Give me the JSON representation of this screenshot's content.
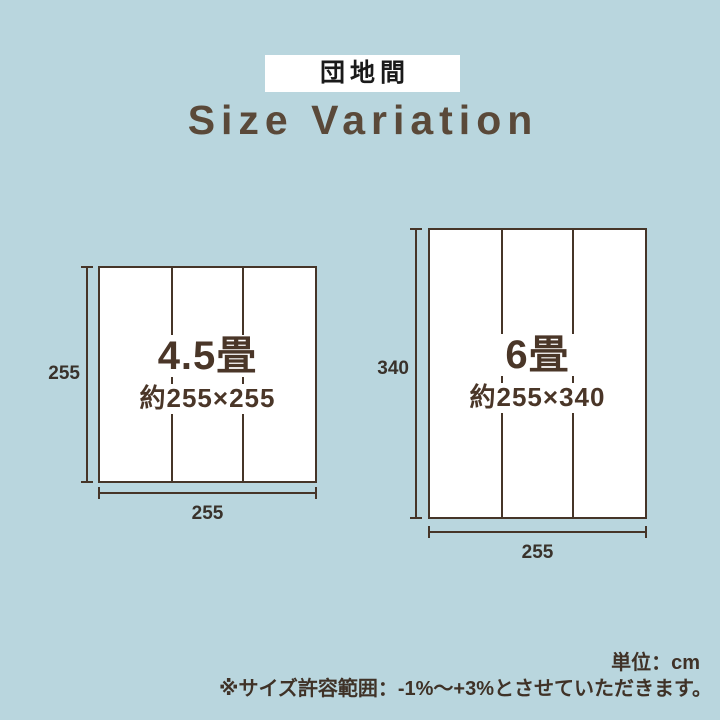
{
  "badge": {
    "label": "団地間"
  },
  "title": "Size Variation",
  "diagrams": [
    {
      "tatami_count": "4.5畳",
      "approx_size": "約255×255",
      "height_cm": "255",
      "width_cm": "255"
    },
    {
      "tatami_count": "6畳",
      "approx_size": "約255×340",
      "height_cm": "340",
      "width_cm": "255"
    }
  ],
  "footer": {
    "unit_note": "単位：cm",
    "tolerance_note": "※サイズ許容範囲：-1%〜+3%とさせていただきます。"
  },
  "colors": {
    "background": "#b9d6de",
    "panel_white": "#ffffff",
    "line_brown": "#463528",
    "label_brown": "#4a3628",
    "title_brown": "#5a4939",
    "number_dark": "#39322b",
    "badge_text": "#1a1a1a"
  }
}
